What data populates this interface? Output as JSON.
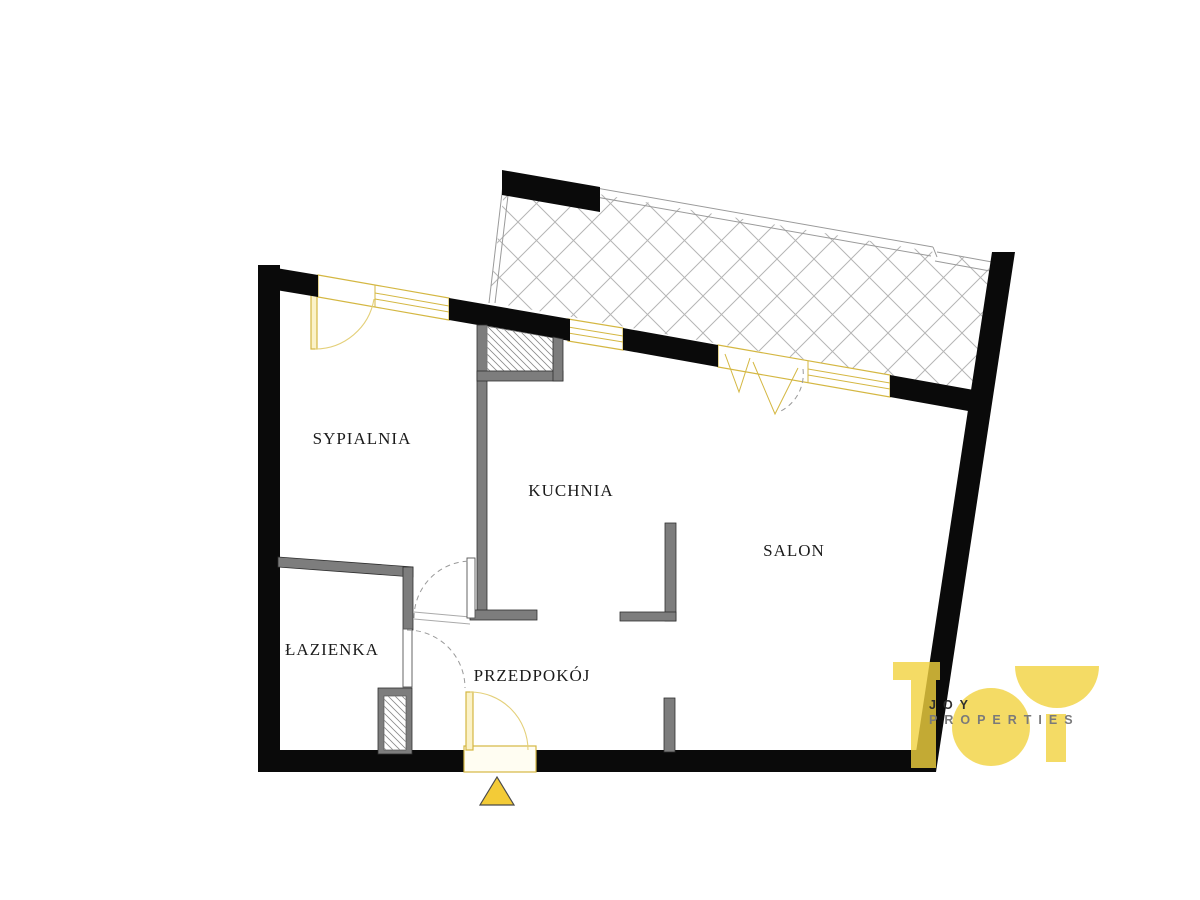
{
  "title": "apartment-floor-plan",
  "rooms": [
    {
      "label": "SYPIALNIA"
    },
    {
      "label": "KUCHNIA"
    },
    {
      "label": "SALON"
    },
    {
      "label": "ŁAZIENKA"
    },
    {
      "label": "PRZEDPOKÓJ"
    }
  ],
  "logo": {
    "name": "JOY",
    "tagline": "PROPERTIES"
  },
  "colors": {
    "exterior_wall": "#0a0a0a",
    "interior_wall": "#7d7d7d",
    "window_yellow": "#d4b742",
    "logo_yellow": "#f1d23e",
    "entrance_marker": "#f3cb37"
  }
}
